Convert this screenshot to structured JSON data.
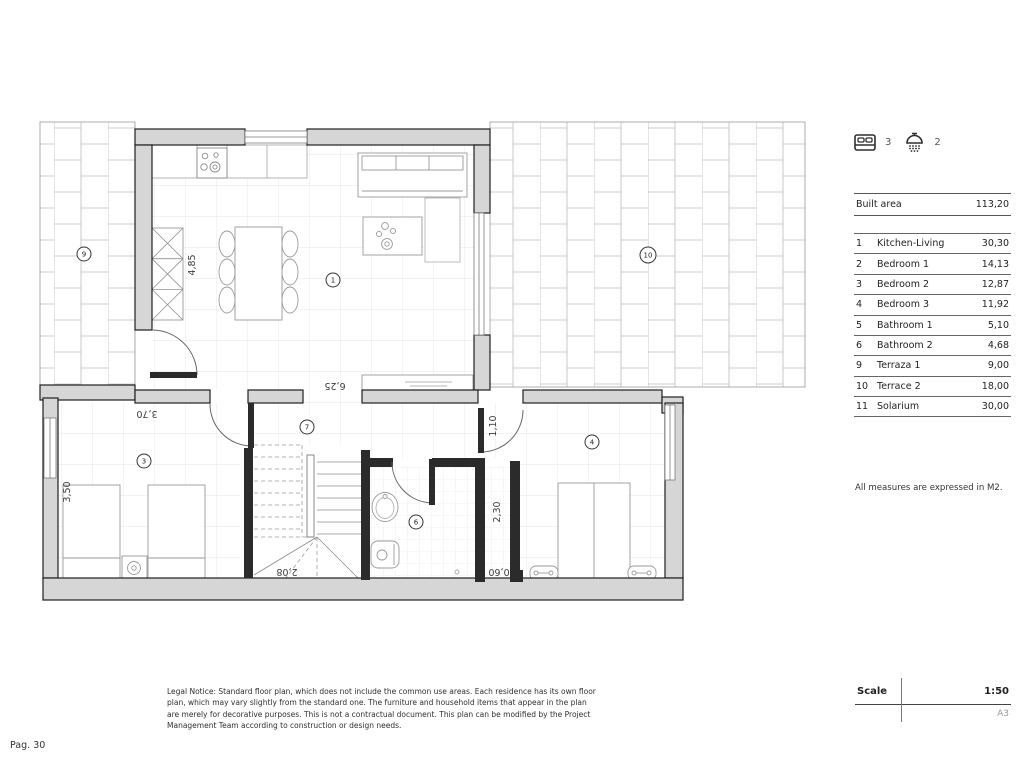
{
  "page": {
    "number_label": "Pag. 30"
  },
  "legend": {
    "bedrooms": "3",
    "bathrooms": "2"
  },
  "built_area": {
    "label": "Built area",
    "value": "113,20"
  },
  "rooms": [
    {
      "no": "1",
      "name": "Kitchen-Living",
      "area": "30,30"
    },
    {
      "no": "2",
      "name": "Bedroom 1",
      "area": "14,13"
    },
    {
      "no": "3",
      "name": "Bedroom 2",
      "area": "12,87"
    },
    {
      "no": "4",
      "name": "Bedroom 3",
      "area": "11,92"
    },
    {
      "no": "5",
      "name": "Bathroom 1",
      "area": "5,10"
    },
    {
      "no": "6",
      "name": "Bathroom 2",
      "area": "4,68"
    },
    {
      "no": "9",
      "name": "Terraza 1",
      "area": "9,00"
    },
    {
      "no": "10",
      "name": "Terrace 2",
      "area": "18,00"
    },
    {
      "no": "11",
      "name": "Solarium",
      "area": "30,00"
    }
  ],
  "note": "All measures are expressed in M2.",
  "scale": {
    "label": "Scale",
    "value": "1:50",
    "sheet": "A3"
  },
  "legal": "Legal Notice: Standard floor plan, which does not include the common use areas. Each residence has its own floor plan, which may vary slightly from the standard one. The furniture and household items that appear in the plan are merely for decorative purposes. This is not a contractual document. This plan can be modified by the Project Management Team according to construction or design needs.",
  "plan": {
    "markers": {
      "kitchen_living": "1",
      "hallway": "7",
      "bedroom2": "3",
      "bathroom2": "6",
      "bedroom3": "4",
      "terrace1": "9",
      "terrace2": "10"
    },
    "dims": {
      "kitchen_width": "4,85",
      "living_width": "6,25",
      "bedroom2_width": "3,70",
      "bedroom2_depth": "3,50",
      "hall_door": "1,10",
      "closet_depth": "2,30",
      "closet_width": "0,60",
      "stairs_width": "2,08"
    },
    "compass": {
      "north": "N",
      "south": "S"
    }
  },
  "colors": {
    "wall_fill": "#d6d6d6",
    "wall_edge": "#1f1f1f",
    "partition": "#2b2b2b",
    "compass_fill": "#f4c98f"
  }
}
